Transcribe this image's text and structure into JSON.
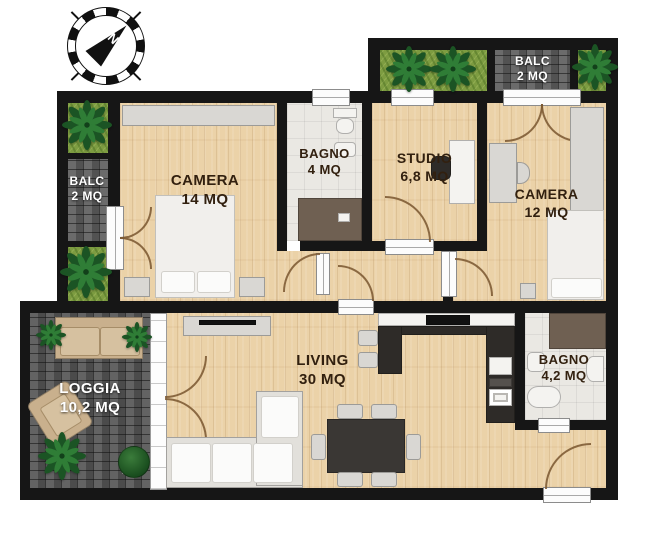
{
  "compass": {
    "north_label": "N"
  },
  "rooms": {
    "balc_left": {
      "name": "BALC",
      "area": "2 MQ"
    },
    "camera14": {
      "name": "CAMERA",
      "area": "14 MQ"
    },
    "bagno4": {
      "name": "BAGNO",
      "area": "4 MQ"
    },
    "studio": {
      "name": "STUDIO",
      "area": "6,8 MQ"
    },
    "balc_top": {
      "name": "BALC",
      "area": "2 MQ"
    },
    "camera12": {
      "name": "CAMERA",
      "area": "12 MQ"
    },
    "living": {
      "name": "LIVING",
      "area": "30 MQ"
    },
    "bagno42": {
      "name": "BAGNO",
      "area": "4,2 MQ"
    },
    "loggia": {
      "name": "LOGGIA",
      "area": "10,2 MQ"
    }
  },
  "colors": {
    "wall": "#161616",
    "wood_floor": "#ebd2a8",
    "tile_floor": "#eae8e3",
    "brick": "#606060",
    "planter_grass": "#7d9c41",
    "palm_green": "#1b5424",
    "shower_brown": "#6f6052",
    "kitchen_dark": "#2e2b28",
    "label_dark": "#32200f",
    "label_light": "#ffffff"
  }
}
